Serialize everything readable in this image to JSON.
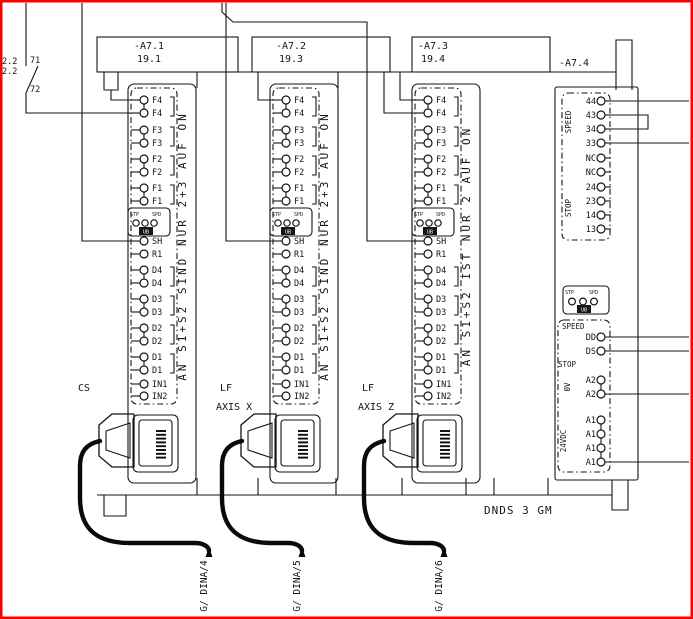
{
  "colors": {
    "frame": "#ff0000",
    "line": "#141414",
    "background": "#ffffff"
  },
  "left_area": {
    "xref_top": "2.2",
    "xref_bottom": "2.2",
    "contact_top": "71",
    "contact_bottom": "72"
  },
  "modules": [
    {
      "name": "-A7.1",
      "sheet": "19.1",
      "side_note": "AN S1+S2 SIND NUR 2+3 AUF ON",
      "tag_line1": "CS",
      "tag_line2": "",
      "cable_ref": "G/ DINA/4",
      "upper_pairs": [
        "F4",
        "F3",
        "F2",
        "F1"
      ],
      "mid_singles": [
        "SH",
        "R1"
      ],
      "lower_pairs": [
        "D4",
        "D3",
        "D2",
        "D1"
      ],
      "inputs": [
        "IN1",
        "IN2"
      ],
      "led": {
        "left": "STP",
        "right": "SPD",
        "bottom": "UB"
      }
    },
    {
      "name": "-A7.2",
      "sheet": "19.3",
      "side_note": "AN S1+S2 SIND NUR 2+3 AUF ON",
      "tag_line1": "LF",
      "tag_line2": "AXIS X",
      "cable_ref": "G/ DINA/5",
      "upper_pairs": [
        "F4",
        "F3",
        "F2",
        "F1"
      ],
      "mid_singles": [
        "SH",
        "R1"
      ],
      "lower_pairs": [
        "D4",
        "D3",
        "D2",
        "D1"
      ],
      "inputs": [
        "IN1",
        "IN2"
      ],
      "led": {
        "left": "STP",
        "right": "SPD",
        "bottom": "UB"
      }
    },
    {
      "name": "-A7.3",
      "sheet": "19.4",
      "side_note": "AN S1+S2 IST NUR 2 AUF ON",
      "tag_line1": "LF",
      "tag_line2": "AXIS Z",
      "cable_ref": "G/ DINA/6",
      "upper_pairs": [
        "F4",
        "F3",
        "F2",
        "F1"
      ],
      "mid_singles": [
        "SH",
        "R1"
      ],
      "lower_pairs": [
        "D4",
        "D3",
        "D2",
        "D1"
      ],
      "inputs": [
        "IN1",
        "IN2"
      ],
      "led": {
        "left": "STP",
        "right": "SPD",
        "bottom": "UB"
      }
    }
  ],
  "module4": {
    "name": "-A7.4",
    "contacts": [
      "44",
      "43",
      "34",
      "33",
      "NC",
      "NC",
      "24",
      "23",
      "14",
      "13"
    ],
    "group_speed": "SPEED",
    "group_stop": "STOP",
    "led": {
      "left": "STP",
      "right": "SPD",
      "bottom": "UB"
    },
    "sec_speed": "SPEED",
    "dd": "DD",
    "ds": "DS",
    "sec_stop": "STOP",
    "a2_terminals": [
      "A2",
      "A2"
    ],
    "a2_note": "0V",
    "a1_terminals": [
      "A1",
      "A1",
      "A1",
      "A1"
    ],
    "a1_note": "24VDC"
  },
  "footer": {
    "unit": "DNDS 3 GM"
  }
}
